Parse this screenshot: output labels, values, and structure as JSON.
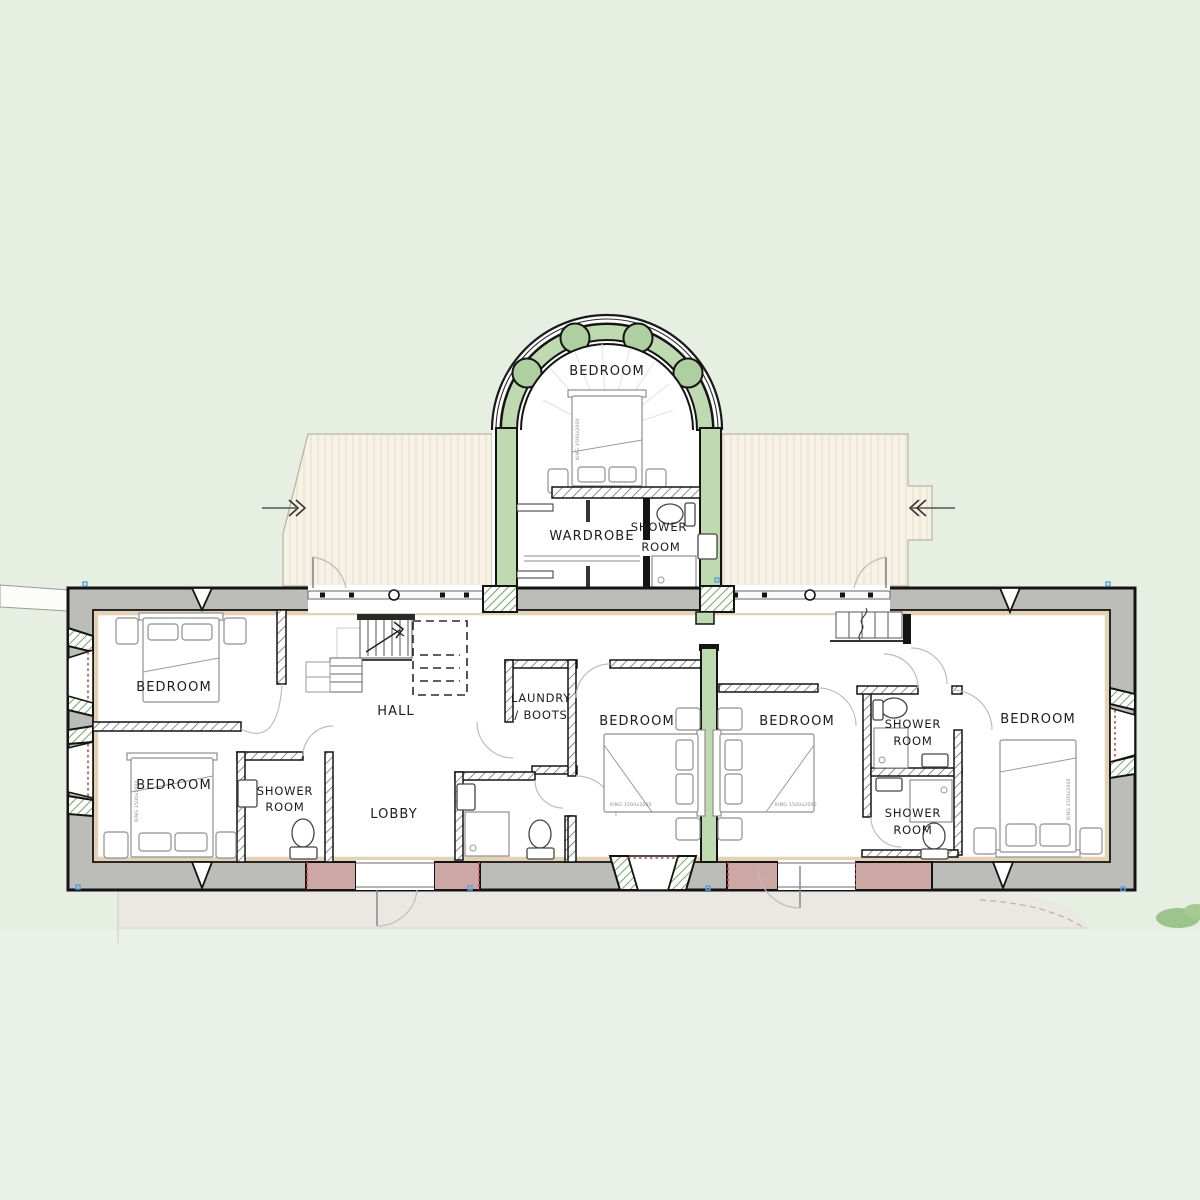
{
  "plan_title": "",
  "rooms": {
    "arch_bedroom": "BEDROOM",
    "wardrobe": "WARDROBE",
    "arch_shower_line1": "SHOWER",
    "arch_shower_line2": "ROOM",
    "bedroom_nw": "BEDROOM",
    "bedroom_sw": "BEDROOM",
    "shower_w_line1": "SHOWER",
    "shower_w_line2": "ROOM",
    "hall": "HALL",
    "lobby": "LOBBY",
    "laundry_line1": "LAUNDRY",
    "laundry_line2": "/ BOOTS",
    "bedroom_c1": "BEDROOM",
    "bedroom_c2": "BEDROOM",
    "shower_ne_line1": "SHOWER",
    "shower_ne_line2": "ROOM",
    "shower_se_line1": "SHOWER",
    "shower_se_line2": "ROOM",
    "bedroom_e": "BEDROOM"
  },
  "beds": {
    "size_label": "KING 1500x2000"
  },
  "colors": {
    "background": "#e7efe3",
    "wall_fill": "#bcbdb9",
    "wall_outline": "#141414",
    "new_wall_fill": "#cda7a4",
    "timber_green": "#bfd9b1",
    "timber_green_dark": "#aed0a0",
    "lining_tan": "#e4d2b6",
    "roof_fill": "#f6f2e5",
    "terrace_fill": "#ebe7e3",
    "opening_red": "#d84040",
    "marker_blue": "#55a0e0"
  }
}
